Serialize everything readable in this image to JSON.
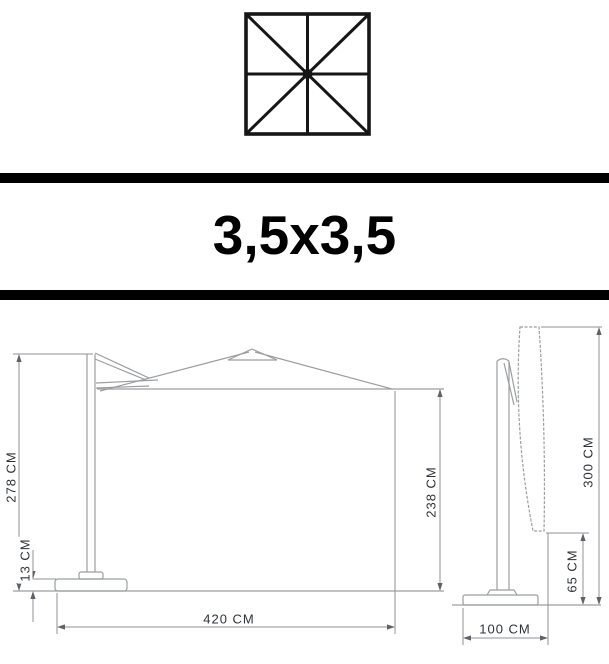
{
  "header": {
    "size_label": "3,5x3,5"
  },
  "top_view": {
    "icon": "square-parasol-top-view-icon"
  },
  "open_view": {
    "name": "parasol-open-side-view",
    "dims": {
      "pole_height": "278 CM",
      "base_height": "13 CM",
      "clearance_height": "238 CM",
      "total_width": "420 CM"
    }
  },
  "closed_view": {
    "name": "parasol-closed-side-view",
    "dims": {
      "total_height": "300 CM",
      "ground_clearance": "65 CM",
      "base_width": "100 CM"
    }
  },
  "colors": {
    "icon_black": "#161616",
    "line_gray": "#9b9ea1",
    "dim_gray": "#8d9094",
    "text_dark": "#2f3338"
  }
}
